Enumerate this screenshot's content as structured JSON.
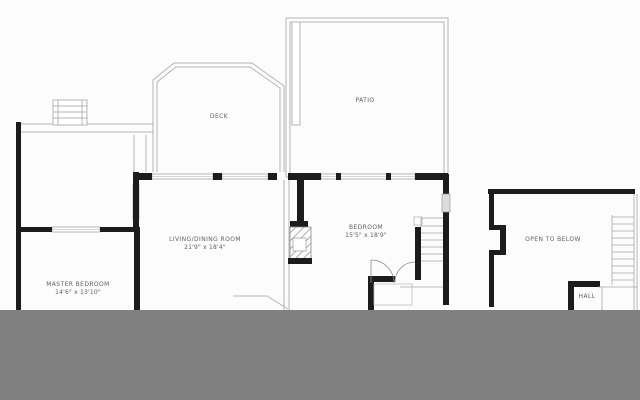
{
  "plan": {
    "type": "floor-plan",
    "rooms": {
      "deck": {
        "label": "DECK"
      },
      "patio": {
        "label": "PATIO"
      },
      "living_dining": {
        "label": "LIVING/DINING ROOM",
        "dimensions": "21'9\" x 18'4\""
      },
      "master_bedroom": {
        "label": "MASTER BEDROOM",
        "dimensions": "14'6\" x 13'10\""
      },
      "bedroom": {
        "label": "BEDROOM",
        "dimensions": "15'5\" x 18'9\""
      },
      "open_to_below": {
        "label": "OPEN TO BELOW"
      },
      "hall": {
        "label": "HALL"
      }
    },
    "colors": {
      "wall": "#1c1c1c",
      "thin_line": "#b4b4b4",
      "window_fill": "#dcdcdc",
      "ground_band": "#808080",
      "background": "#fcfcfc",
      "label_text": "#5f5f5f"
    }
  }
}
